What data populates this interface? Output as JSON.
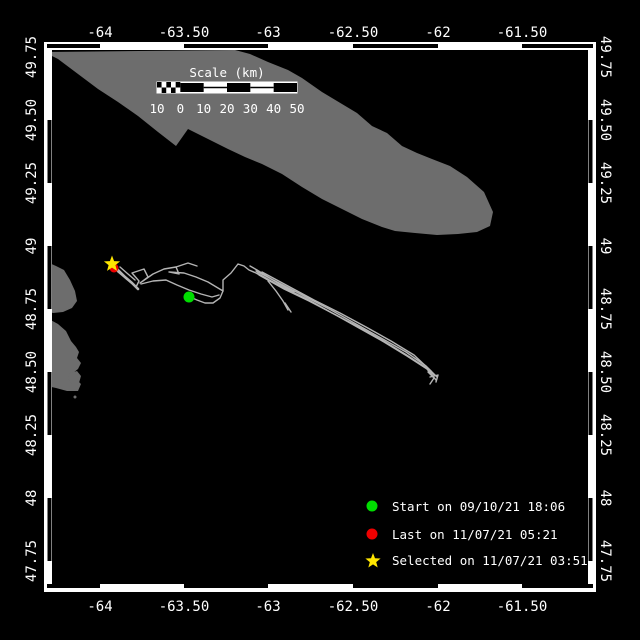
{
  "colors": {
    "background": "#000000",
    "land": "#6d6d6d",
    "track": "#b4b4b4",
    "frame_white": "#ffffff",
    "frame_black": "#000000",
    "text": "#ffffff",
    "start_green": "#00dd00",
    "last_red": "#ee0000",
    "selected_yellow": "#ffe600"
  },
  "frame": {
    "x": 44,
    "y": 42,
    "w": 552,
    "h": 550,
    "band": 8,
    "x_black_segments": [
      [
        47,
        100
      ],
      [
        184,
        268
      ],
      [
        353,
        438
      ],
      [
        522,
        593
      ]
    ],
    "y_black_segments": [
      [
        120,
        183
      ],
      [
        246,
        309
      ],
      [
        372,
        435
      ],
      [
        498,
        561
      ]
    ]
  },
  "axes": {
    "top_label_y": 37,
    "bottom_label_y": 611,
    "left_label_x": 31,
    "right_label_x": 606,
    "x_ticks": [
      {
        "t": "-64",
        "x": 100
      },
      {
        "t": "-63.50",
        "x": 184
      },
      {
        "t": "-63",
        "x": 268
      },
      {
        "t": "-62.50",
        "x": 353
      },
      {
        "t": "-62",
        "x": 438
      },
      {
        "t": "-61.50",
        "x": 522
      }
    ],
    "y_ticks": [
      {
        "t": "49.75",
        "y": 57
      },
      {
        "t": "49.50",
        "y": 120
      },
      {
        "t": "49.25",
        "y": 183
      },
      {
        "t": "49",
        "y": 246
      },
      {
        "t": "48.75",
        "y": 309
      },
      {
        "t": "48.50",
        "y": 372
      },
      {
        "t": "48.25",
        "y": 435
      },
      {
        "t": "48",
        "y": 498
      },
      {
        "t": "47.75",
        "y": 561
      }
    ]
  },
  "scalebar": {
    "title": "Scale (km)",
    "title_x": 227,
    "title_y": 77,
    "x": 157,
    "y": 82,
    "w": 140,
    "h": 11,
    "labels": [
      "10",
      "0",
      "10",
      "20",
      "30",
      "40",
      "50"
    ],
    "labels_y": 113
  },
  "legend": {
    "marker_x": 372,
    "text_x": 392,
    "items": [
      {
        "marker": "circle",
        "color": "#00dd00",
        "y": 506,
        "label": "Start on 09/10/21 18:06"
      },
      {
        "marker": "circle",
        "color": "#ee0000",
        "y": 534,
        "label": "Last on 11/07/21 05:21"
      },
      {
        "marker": "star",
        "color": "#ffe600",
        "y": 560,
        "label": "Selected on 11/07/21 03:51"
      }
    ]
  },
  "map_markers": {
    "start": {
      "x": 189,
      "y": 297,
      "r": 5.5,
      "color": "#00dd00"
    },
    "last": {
      "x": 114,
      "y": 268,
      "r": 4.5,
      "color": "#ee0000"
    },
    "selected": {
      "x": 112,
      "y": 264,
      "ro": 8.5,
      "ri": 3.6,
      "color": "#ffe600"
    }
  },
  "land": [
    {
      "name": "anticosti-island",
      "pts": [
        [
          48,
          52
        ],
        [
          235,
          50
        ],
        [
          250,
          54
        ],
        [
          268,
          62
        ],
        [
          288,
          70
        ],
        [
          302,
          78
        ],
        [
          322,
          92
        ],
        [
          342,
          104
        ],
        [
          357,
          113
        ],
        [
          372,
          126
        ],
        [
          387,
          133
        ],
        [
          402,
          146
        ],
        [
          417,
          153
        ],
        [
          432,
          159
        ],
        [
          450,
          166
        ],
        [
          467,
          177
        ],
        [
          484,
          192
        ],
        [
          493,
          212
        ],
        [
          490,
          226
        ],
        [
          477,
          232
        ],
        [
          458,
          234
        ],
        [
          437,
          235
        ],
        [
          415,
          233
        ],
        [
          395,
          231
        ],
        [
          382,
          227
        ],
        [
          362,
          219
        ],
        [
          342,
          209
        ],
        [
          322,
          199
        ],
        [
          302,
          187
        ],
        [
          282,
          174
        ],
        [
          262,
          164
        ],
        [
          245,
          157
        ],
        [
          228,
          149
        ],
        [
          208,
          139
        ],
        [
          188,
          129
        ],
        [
          176,
          146
        ],
        [
          158,
          132
        ],
        [
          138,
          116
        ],
        [
          118,
          102
        ],
        [
          98,
          89
        ],
        [
          78,
          74
        ],
        [
          58,
          59
        ],
        [
          48,
          54
        ]
      ]
    },
    {
      "name": "west-coast-upper",
      "pts": [
        [
          47,
          262
        ],
        [
          56,
          266
        ],
        [
          64,
          270
        ],
        [
          70,
          280
        ],
        [
          75,
          291
        ],
        [
          77,
          301
        ],
        [
          72,
          308
        ],
        [
          63,
          312
        ],
        [
          53,
          313
        ],
        [
          47,
          311
        ]
      ]
    },
    {
      "name": "west-coast-lower",
      "pts": [
        [
          47,
          318
        ],
        [
          58,
          324
        ],
        [
          66,
          331
        ],
        [
          71,
          341
        ],
        [
          76,
          347
        ],
        [
          79,
          352
        ],
        [
          77,
          358
        ],
        [
          81,
          363
        ],
        [
          78,
          369
        ],
        [
          73,
          373
        ],
        [
          76,
          379
        ],
        [
          81,
          384
        ],
        [
          78,
          391
        ],
        [
          67,
          391
        ],
        [
          56,
          388
        ],
        [
          47,
          386
        ]
      ]
    },
    {
      "name": "west-islet",
      "pts": [
        [
          70,
          373
        ],
        [
          77,
          371
        ],
        [
          81,
          376
        ],
        [
          79,
          383
        ],
        [
          72,
          384
        ],
        [
          68,
          379
        ]
      ]
    }
  ],
  "land_dots": [
    {
      "x": 75,
      "y": 397,
      "r": 1.5
    }
  ],
  "track": [
    {
      "w": 1.4,
      "pts": [
        [
          113,
          266
        ],
        [
          118,
          272
        ],
        [
          124,
          277
        ],
        [
          130,
          282
        ],
        [
          136,
          287
        ],
        [
          139,
          281
        ],
        [
          132,
          273
        ],
        [
          144,
          269
        ],
        [
          148,
          277
        ],
        [
          140,
          283
        ],
        [
          153,
          274
        ],
        [
          164,
          269
        ],
        [
          176,
          267
        ],
        [
          179,
          274
        ],
        [
          169,
          272
        ],
        [
          184,
          273
        ],
        [
          196,
          277
        ],
        [
          208,
          282
        ],
        [
          218,
          288
        ],
        [
          223,
          291
        ],
        [
          223,
          280
        ],
        [
          231,
          273
        ],
        [
          238,
          264
        ],
        [
          244,
          266
        ],
        [
          249,
          270
        ],
        [
          256,
          273
        ],
        [
          263,
          277
        ]
      ]
    },
    {
      "w": 1.4,
      "pts": [
        [
          190,
          297
        ],
        [
          197,
          300
        ],
        [
          205,
          303
        ],
        [
          213,
          303
        ],
        [
          220,
          298
        ],
        [
          223,
          291
        ]
      ]
    },
    {
      "w": 1.4,
      "pts": [
        [
          141,
          284
        ],
        [
          153,
          281
        ],
        [
          166,
          280
        ],
        [
          177,
          285
        ],
        [
          189,
          290
        ],
        [
          201,
          294
        ],
        [
          212,
          297
        ],
        [
          219,
          295
        ]
      ]
    },
    {
      "w": 1.4,
      "pts": [
        [
          176,
          267
        ],
        [
          188,
          263
        ],
        [
          197,
          266
        ]
      ]
    },
    {
      "w": 2.6,
      "pts": [
        [
          117,
          269
        ],
        [
          125,
          277
        ],
        [
          132,
          283
        ],
        [
          138,
          289
        ]
      ]
    },
    {
      "w": 1.4,
      "pts": [
        [
          120,
          267
        ],
        [
          128,
          274
        ],
        [
          135,
          280
        ]
      ]
    },
    {
      "w": 1.4,
      "pts": [
        [
          256,
          271
        ],
        [
          281,
          284
        ],
        [
          306,
          297
        ],
        [
          331,
          310
        ],
        [
          356,
          324
        ],
        [
          381,
          338
        ],
        [
          406,
          352
        ],
        [
          426,
          366
        ],
        [
          437,
          377
        ]
      ]
    },
    {
      "w": 1.4,
      "pts": [
        [
          259,
          275
        ],
        [
          284,
          289
        ],
        [
          309,
          301
        ],
        [
          334,
          314
        ],
        [
          359,
          328
        ],
        [
          384,
          342
        ],
        [
          407,
          356
        ],
        [
          427,
          369
        ],
        [
          436,
          380
        ]
      ]
    },
    {
      "w": 1.4,
      "pts": [
        [
          262,
          272
        ],
        [
          288,
          286
        ],
        [
          314,
          300
        ],
        [
          340,
          313
        ],
        [
          366,
          327
        ],
        [
          391,
          341
        ],
        [
          414,
          355
        ],
        [
          431,
          371
        ]
      ]
    },
    {
      "w": 1.4,
      "pts": [
        [
          257,
          273
        ],
        [
          282,
          287
        ],
        [
          307,
          299
        ],
        [
          332,
          313
        ],
        [
          357,
          326
        ],
        [
          382,
          340
        ],
        [
          405,
          354
        ],
        [
          425,
          367
        ],
        [
          434,
          375
        ]
      ]
    },
    {
      "w": 1.4,
      "pts": [
        [
          250,
          266
        ],
        [
          257,
          270
        ],
        [
          268,
          277
        ],
        [
          281,
          285
        ],
        [
          294,
          292
        ]
      ]
    },
    {
      "w": 1.4,
      "pts": [
        [
          268,
          281
        ],
        [
          276,
          291
        ],
        [
          283,
          301
        ],
        [
          288,
          310
        ]
      ]
    },
    {
      "w": 1.4,
      "pts": [
        [
          285,
          303
        ],
        [
          291,
          312
        ]
      ]
    },
    {
      "w": 1.4,
      "pts": [
        [
          428,
          372
        ],
        [
          434,
          378
        ],
        [
          430,
          384
        ]
      ]
    },
    {
      "w": 1.4,
      "pts": [
        [
          430,
          377
        ],
        [
          438,
          375
        ],
        [
          436,
          382
        ]
      ]
    }
  ]
}
